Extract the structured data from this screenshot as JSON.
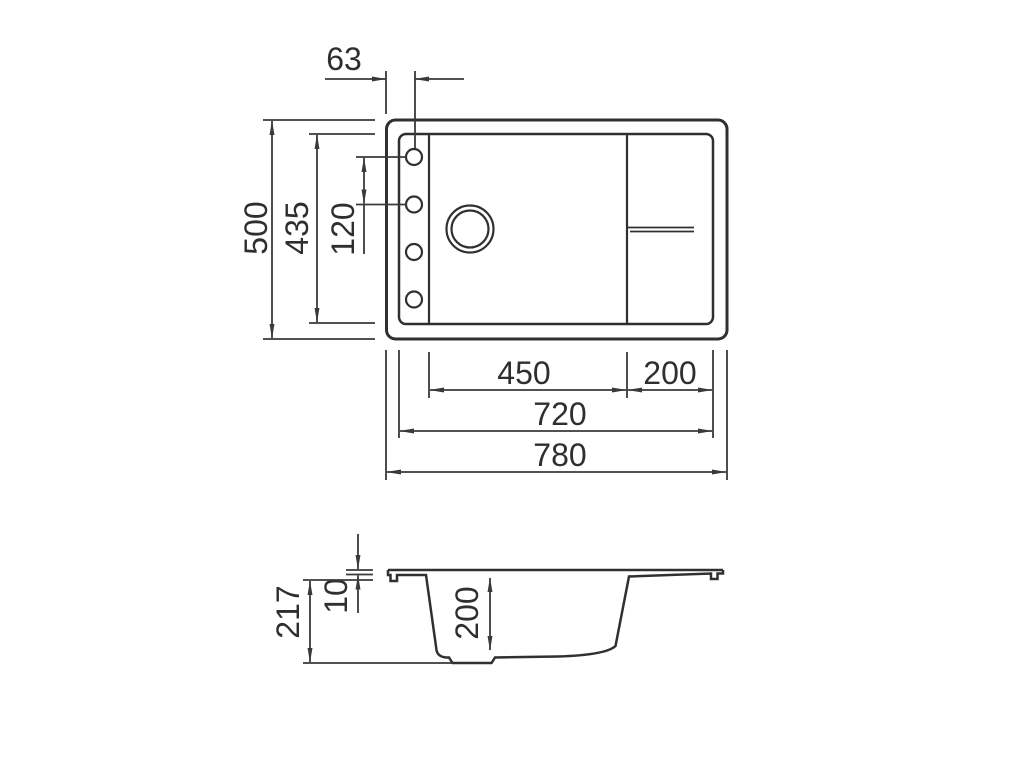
{
  "drawing": {
    "colors": {
      "background": "#ffffff",
      "object_line": "#303030",
      "dimension_line": "#3a3a3a",
      "text": "#2f2f2f"
    },
    "top_view": {
      "overall_width": "780",
      "inner_width": "720",
      "bowl_width": "450",
      "drainboard_width": "200",
      "overall_depth": "500",
      "inner_depth": "435",
      "tap_hole_offset": "63",
      "tap_hole_spacing": "120"
    },
    "side_view": {
      "overall_height": "217",
      "rim_thickness": "10",
      "bowl_depth": "200"
    }
  }
}
